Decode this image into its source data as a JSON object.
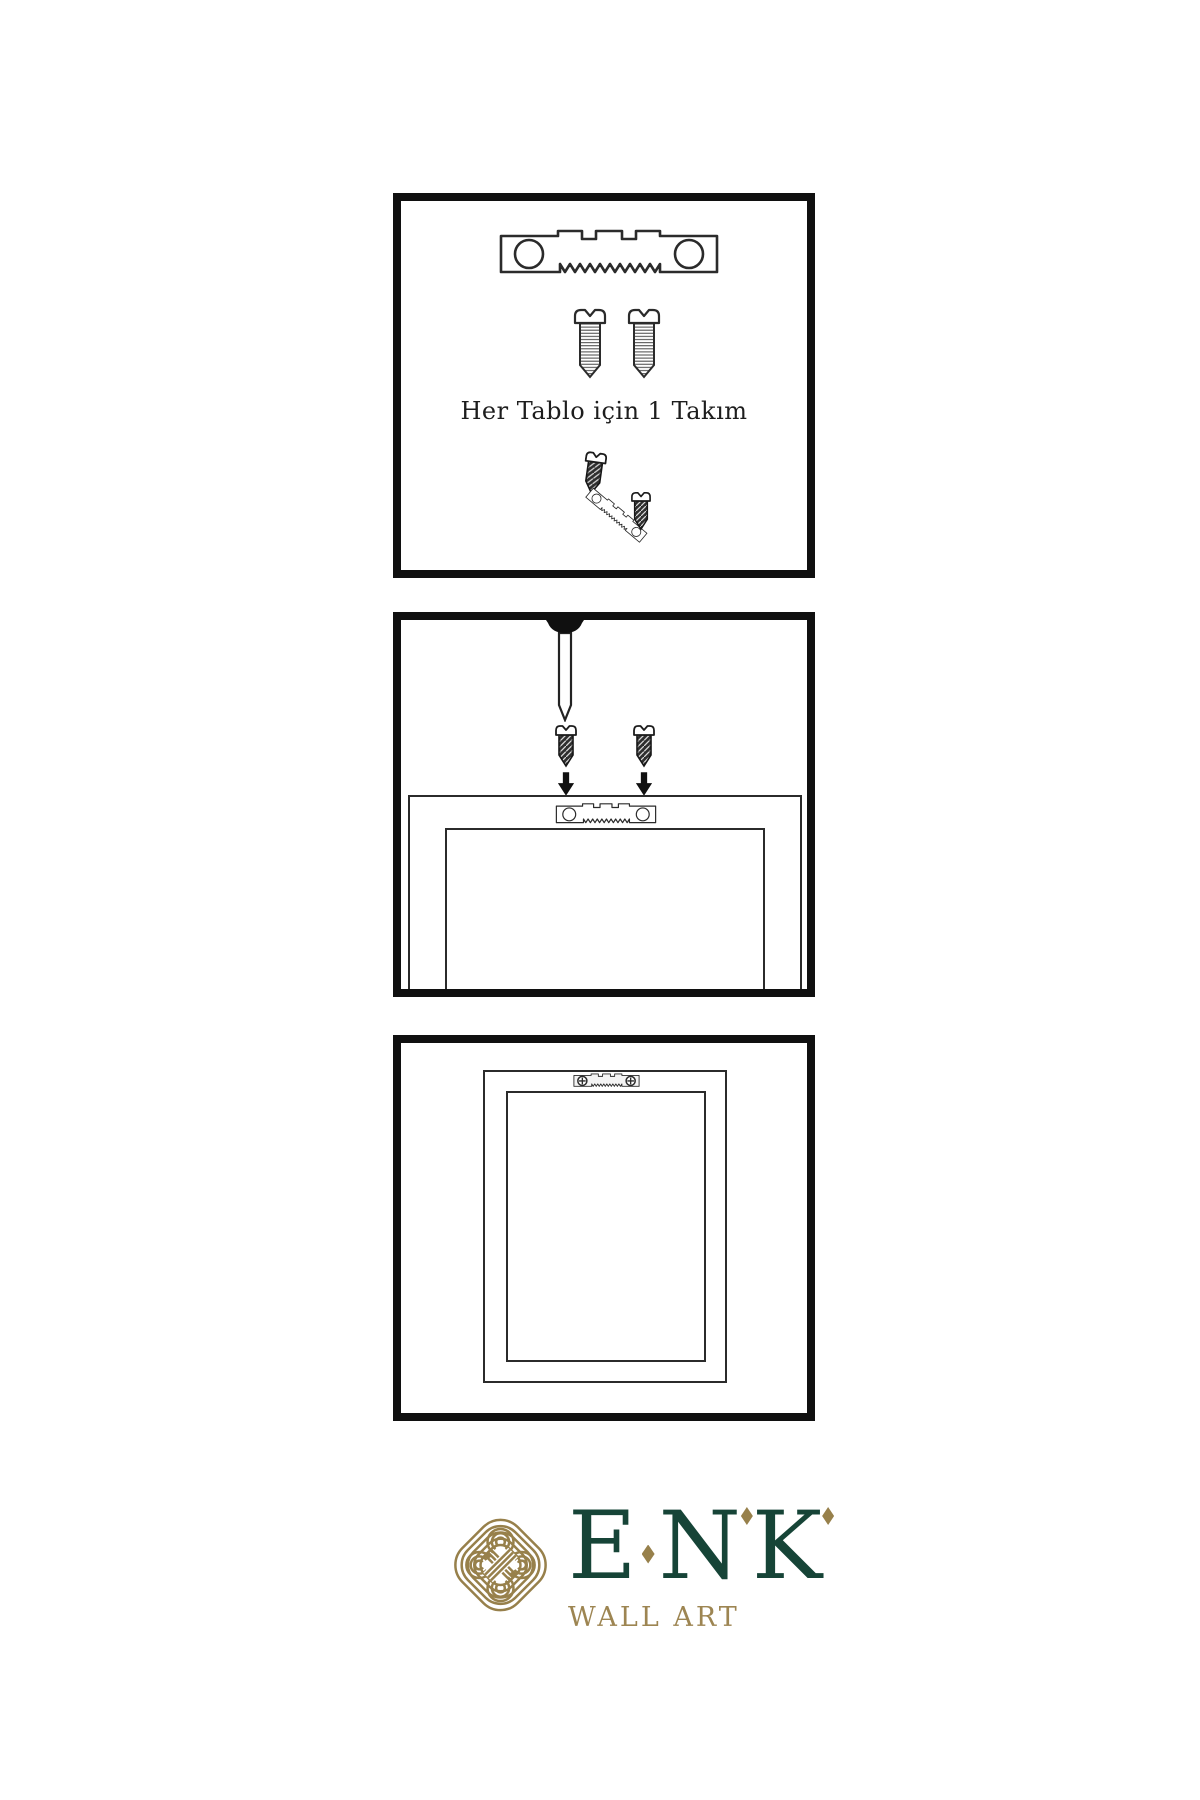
{
  "panels": {
    "step1": {
      "caption": "Her Tablo için 1 Takım"
    },
    "step2": {
      "description_icons": [
        "nail-icon",
        "screw-icon",
        "arrow-down-icon",
        "sawtooth-hanger-icon"
      ]
    },
    "step3": {
      "description_icons": [
        "mounted-hanger-icon",
        "picture-frame"
      ]
    }
  },
  "brand": {
    "letters": [
      "E",
      "N",
      "K"
    ],
    "name": "ENK",
    "subtitle": "WALL ART",
    "colors": {
      "green": "#164437",
      "gold": "#97804b"
    }
  },
  "colors": {
    "background": "#ffffff",
    "panel_border": "#101010",
    "line_art": "#2b2b2b"
  }
}
